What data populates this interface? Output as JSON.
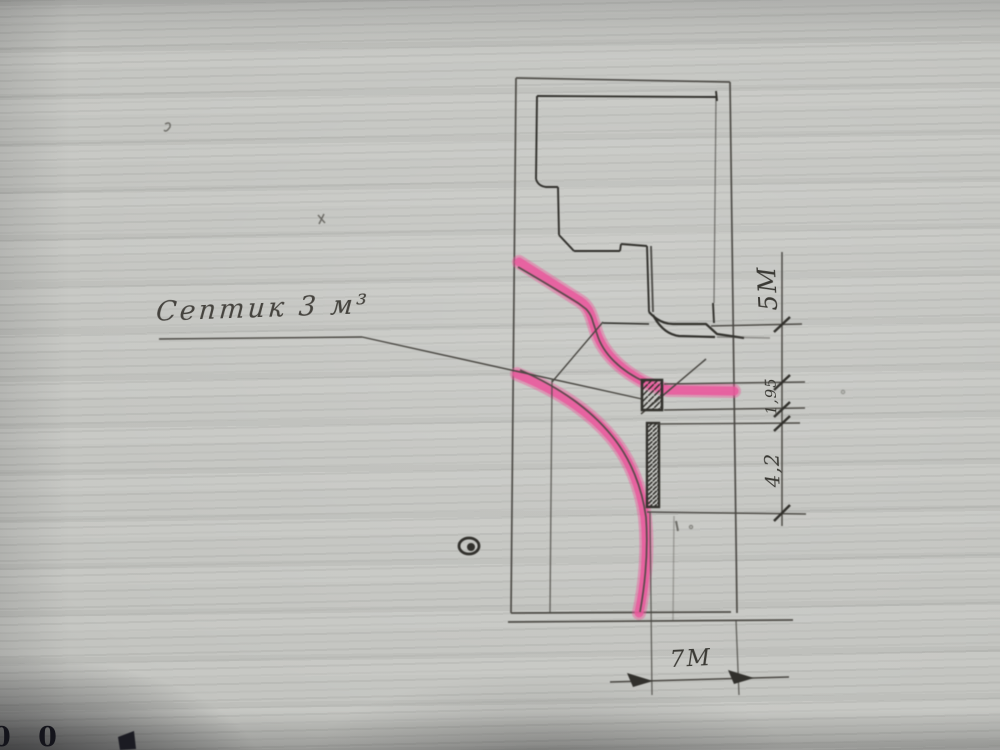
{
  "photo": {
    "description": "Photograph of a hand-drawn site plan sketch in pencil with pink highlighter on gray paper"
  },
  "labels": {
    "septic_tank": "Септик 3 м³"
  },
  "dimensions": {
    "right_top": "5М",
    "right_middle": "1,95",
    "right_lower": "4,2",
    "bottom": "7М"
  },
  "corner_marks": {
    "text": "0 0"
  },
  "symbols": {
    "well": "circled-dot",
    "septic_tank": "hatched-square",
    "trench": "hatched-bar"
  },
  "colors": {
    "paper": "#c4c5c1",
    "pencil": "#4a4843",
    "pencil_dark": "#33322e",
    "ink_dark": "#1d1d24",
    "highlighter_pink": "#e85a9c"
  }
}
